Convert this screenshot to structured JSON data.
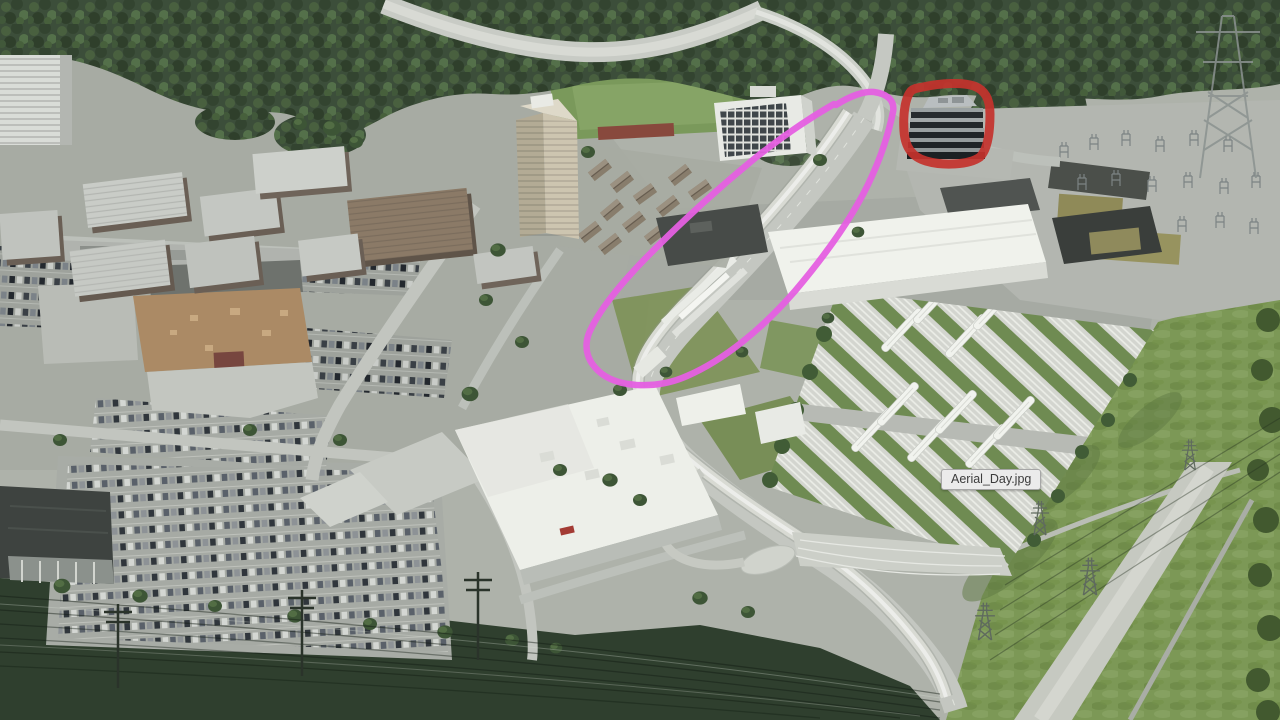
{
  "tooltip": {
    "label": "Aerial_Day.jpg"
  },
  "annotations": {
    "red_circle": {
      "color": "#c4322c",
      "shape": "hand-drawn circle around dark office building"
    },
    "magenta_loop": {
      "color": "#e55fe2",
      "shape": "hand-drawn loop around elevated transit corridor"
    }
  },
  "scene": {
    "type": "aerial-day-render"
  }
}
